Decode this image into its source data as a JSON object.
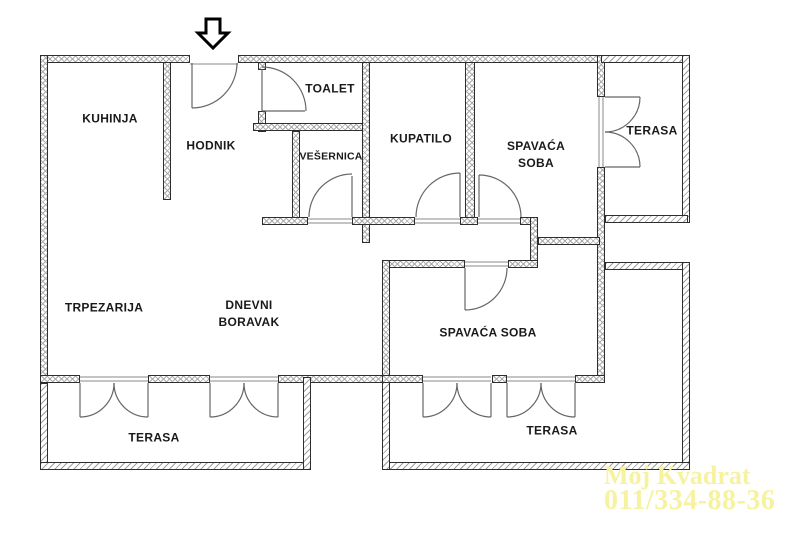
{
  "plan": {
    "type": "apartment-floor-plan",
    "rooms": {
      "kuhinja": {
        "label": "KUHINJA"
      },
      "hodnik": {
        "label": "HODNIK"
      },
      "toalet": {
        "label": "TOALET"
      },
      "vesernica": {
        "label": "VEŠERNICA"
      },
      "kupatilo": {
        "label": "KUPATILO"
      },
      "spavaca_soba_1": {
        "label_line1": "SPAVAĆA",
        "label_line2": "SOBA"
      },
      "terasa_1": {
        "label": "TERASA"
      },
      "trpezarija": {
        "label": "TRPEZARIJA"
      },
      "dnevni_boravak": {
        "label_line1": "DNEVNI",
        "label_line2": "BORAVAK"
      },
      "spavaca_soba_2": {
        "label": "SPAVAĆA SOBA"
      },
      "terasa_2": {
        "label": "TERASA"
      },
      "terasa_3": {
        "label": "TERASA"
      }
    },
    "entrance": {
      "icon": "entrance-arrow-down-icon"
    },
    "watermark": {
      "line1": "Moj Kvadrat",
      "line2": "011/334-88-36",
      "color": "#f7f2a0"
    },
    "colors": {
      "background": "#ffffff",
      "wall_outline": "#2e2e2e",
      "wall_hatch_interior": "#ababab",
      "wall_hatch_terrace": "#9f9f9f",
      "door_line": "#666666",
      "label_text": "#1a1a1a"
    }
  }
}
